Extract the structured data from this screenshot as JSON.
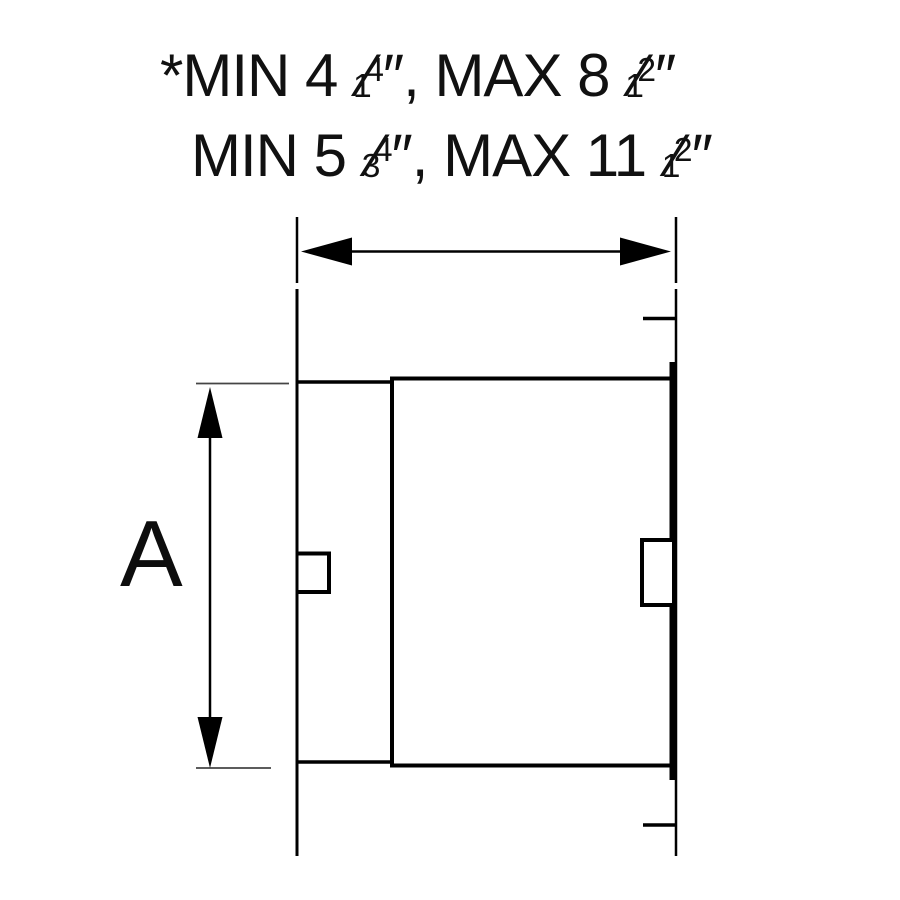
{
  "colors": {
    "background": "#ffffff",
    "ink": "#111111",
    "line": "#000000",
    "extension_line": "#454545"
  },
  "notes": {
    "line1": {
      "prefix": "*MIN 4 ",
      "f1_lo": "1",
      "f1_slash": "⁄",
      "f1_hi": "4",
      "mid": "″, MAX 8 ",
      "f2_lo": "1",
      "f2_slash": "⁄",
      "f2_hi": "2",
      "suffix": "″"
    },
    "line2": {
      "prefix": "MIN 5 ",
      "f1_lo": "3",
      "f1_slash": "⁄",
      "f1_hi": "4",
      "mid": "″, MAX 11 ",
      "f2_lo": "1",
      "f2_slash": "⁄",
      "f2_hi": "2",
      "suffix": "″"
    }
  },
  "diagram": {
    "dim_a_label": "A"
  }
}
